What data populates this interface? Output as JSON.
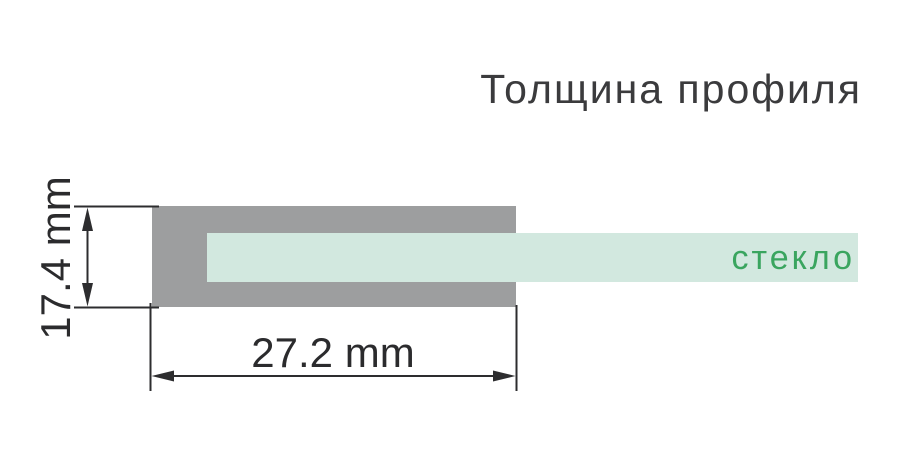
{
  "title": "Толщина профиля",
  "diagram": {
    "profile": {
      "description_name": "profile-cross-section",
      "width_dimension_label": "27.2 mm",
      "height_dimension_label": "17.4 mm"
    },
    "glass": {
      "label": "стекло"
    }
  },
  "colors": {
    "background": "#ffffff",
    "profile_gray": "#9d9e9f",
    "glass_mint": "#d2e8df",
    "glass_label_green": "#3aa55f",
    "title_text": "#3b3b3d",
    "dimension_ink": "#2d2d2f"
  }
}
